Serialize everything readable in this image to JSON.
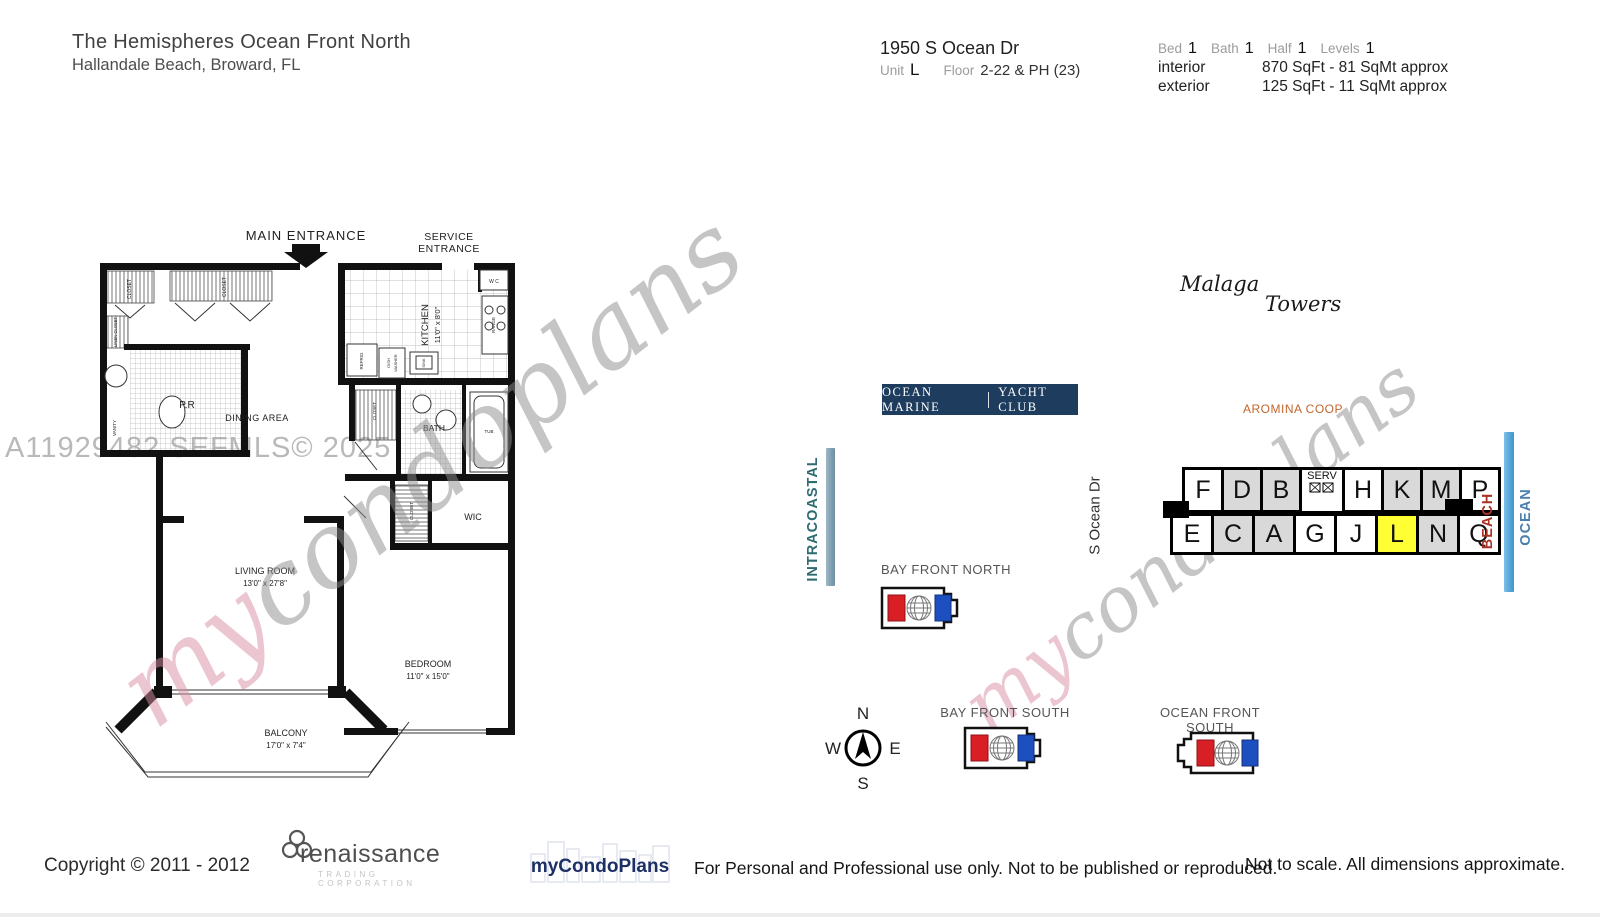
{
  "header": {
    "title": "The Hemispheres Ocean Front North",
    "subtitle": "Hallandale Beach, Broward, FL",
    "address": "1950 S Ocean Dr",
    "unit_label": "Unit",
    "unit_value": "L",
    "floor_label": "Floor",
    "floor_value": "2-22 & PH (23)",
    "stats": {
      "bed_label": "Bed",
      "bed": "1",
      "bath_label": "Bath",
      "bath": "1",
      "half_label": "Half",
      "half": "1",
      "levels_label": "Levels",
      "levels": "1",
      "interior_label": "interior",
      "interior_value": "870 SqFt - 81 SqMt approx",
      "exterior_label": "exterior",
      "exterior_value": "125 SqFt - 11 SqMt approx"
    }
  },
  "floorplan": {
    "main_entrance": "MAIN ENTRANCE",
    "service_entrance_line1": "SERVICE",
    "service_entrance_line2": "ENTRANCE",
    "closet": "CLOSET",
    "linen_closet": "LINEN CLOSET",
    "powder_room": "P.R",
    "vanity": "VANITY",
    "dining": "DINING AREA",
    "kitchen": "KITCHEN",
    "kitchen_dim": "11'0\" x 8'0\"",
    "refrig": "REFRIG",
    "dishwasher_1": "DISH",
    "dishwasher_2": "WASHER",
    "sink": "SINK",
    "range": "RANGE",
    "wc": "W C",
    "bath": "BATH",
    "tub": "TUB",
    "wic": "WIC",
    "living": "LIVING ROOM",
    "living_dim": "13'0\" x 27'8\"",
    "bedroom": "BEDROOM",
    "bedroom_dim": "11'0\" x 15'0\"",
    "balcony": "BALCONY",
    "balcony_dim": "17'0\" x 7'4\""
  },
  "sitemap": {
    "yacht_club_left": "OCEAN MARINE",
    "yacht_club_right": "YACHT CLUB",
    "malaga": "Malaga",
    "towers": "Towers",
    "aromina": "AROMINA COOP",
    "intracoastal": "INTRACOASTAL",
    "street": "S Ocean Dr",
    "beach": "BEACH",
    "ocean": "OCEAN",
    "units_top": [
      "F",
      "D",
      "B",
      "SERV",
      "H",
      "K",
      "M",
      "P"
    ],
    "units_bottom": [
      "E",
      "C",
      "A",
      "G",
      "J",
      "L",
      "N",
      "Q"
    ],
    "highlighted_unit": "L",
    "bay_front_north": "BAY FRONT NORTH",
    "bay_front_south": "BAY FRONT SOUTH",
    "ocean_front_south": "OCEAN FRONT SOUTH",
    "compass": {
      "n": "N",
      "e": "E",
      "s": "S",
      "w": "W"
    }
  },
  "watermarks": {
    "mls": "A11929482  SEFMLS© 2025",
    "brand_my": "my",
    "brand_rest": "condoplans"
  },
  "footer": {
    "copyright": "Copyright © 2011 - 2012",
    "renaissance": "renaissance",
    "renaissance_sub": "TRADING CORPORATION",
    "mycondoplans": "myCondoPlans",
    "usage": "For Personal and Professional use only.  Not to be published or reproduced.",
    "disclaimer": "Not to scale.  All dimensions approximate."
  },
  "colors": {
    "yacht_club_bg": "#1e3c5e",
    "aromina": "#c2662e",
    "intracoastal_text": "#2e6b72",
    "beach_text": "#a93226",
    "ocean_text": "#4a7fae",
    "water_bar": "#5aa3d6",
    "highlight_cell": "#ffff33",
    "gray_cell": "#d9d9d9",
    "brand_navy": "#1d3066",
    "icon_red": "#d81f26",
    "icon_blue": "#1d4fc0"
  }
}
